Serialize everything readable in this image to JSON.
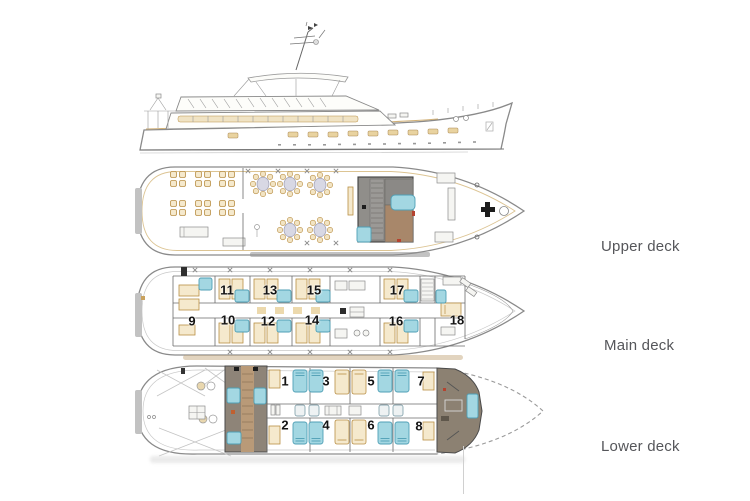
{
  "diagram": {
    "type": "ship-deck-plan",
    "side_profile": {
      "description": "yacht side profile line drawing"
    },
    "decks": {
      "upper": {
        "label": "Upper deck"
      },
      "main": {
        "label": "Main deck",
        "cabins": [
          "9",
          "10",
          "11",
          "12",
          "13",
          "14",
          "15",
          "16",
          "17",
          "18"
        ]
      },
      "lower": {
        "label": "Lower deck",
        "cabins": [
          "1",
          "2",
          "3",
          "4",
          "5",
          "6",
          "7",
          "8"
        ]
      }
    },
    "colors": {
      "accent_tan": "#c9a25e",
      "tan_fill": "#f5e9cd",
      "bathroom_cyan": "#a3d7e2",
      "structure_gray": "#908e8a",
      "structure_brown": "#a8876a",
      "bow_block_gray": "#8c8172",
      "label_text": "#55565a"
    }
  }
}
